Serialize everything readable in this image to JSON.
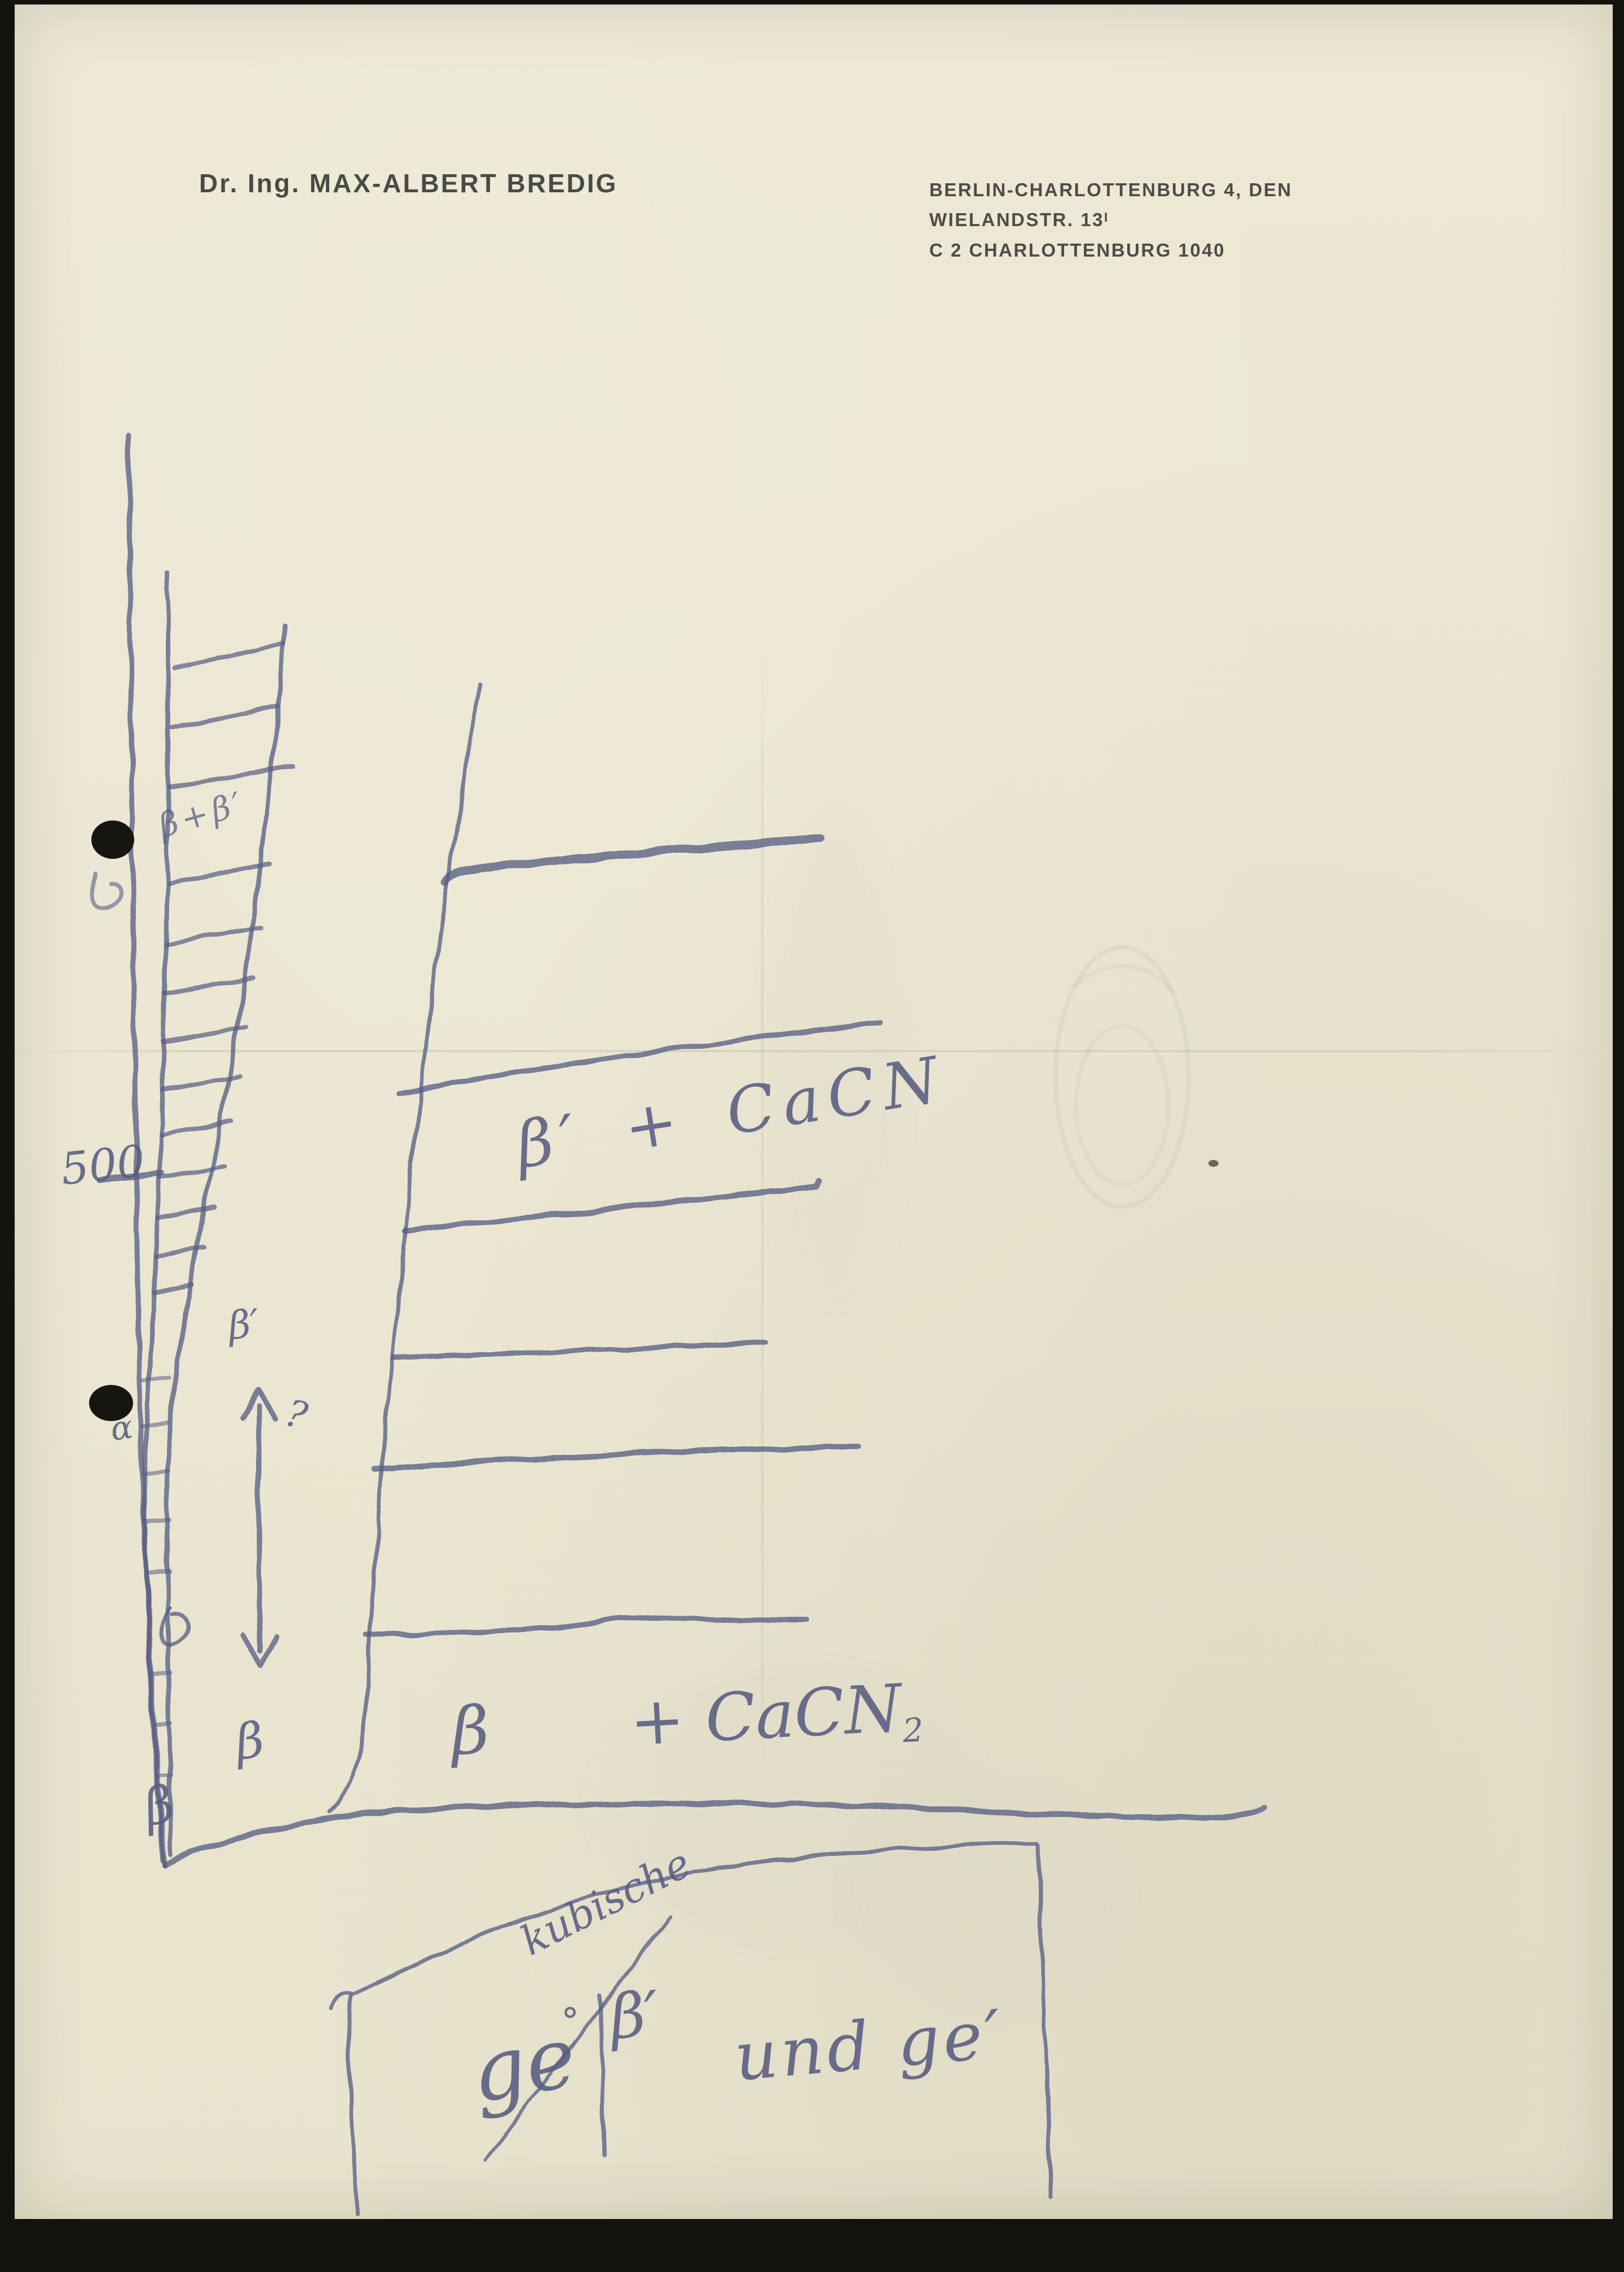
{
  "page": {
    "paper_color": "#ebe7d3",
    "ink_color": "#565b80",
    "type_color": "#4a4a46"
  },
  "letterhead": {
    "name": "Dr. Ing. MAX-ALBERT BREDIG",
    "address_line1": "BERLIN-CHARLOTTENBURG 4, DEN",
    "address_line2": "WIELANDSTR. 13",
    "address_line2_sup": "I",
    "address_line3": "C 2 CHARLOTTENBURG 1040"
  },
  "sketch": {
    "axis_tick_label": "500",
    "wedge_note": "β+β′",
    "left_labels": {
      "beta_prime": "β′",
      "question": "?",
      "alpha": "α",
      "beta": "β",
      "beta_axis_bottom": "β"
    },
    "region_labels": {
      "upper": "β′ + CaCN",
      "lower_beta": "β",
      "lower_rest": "+ CaCN",
      "lower_sub": "2"
    },
    "bottom_note": {
      "ge": "ge",
      "ge_sup": "°",
      "kubische": "kubische",
      "beta_prime": "β′",
      "und_ge": "und ge′"
    }
  }
}
